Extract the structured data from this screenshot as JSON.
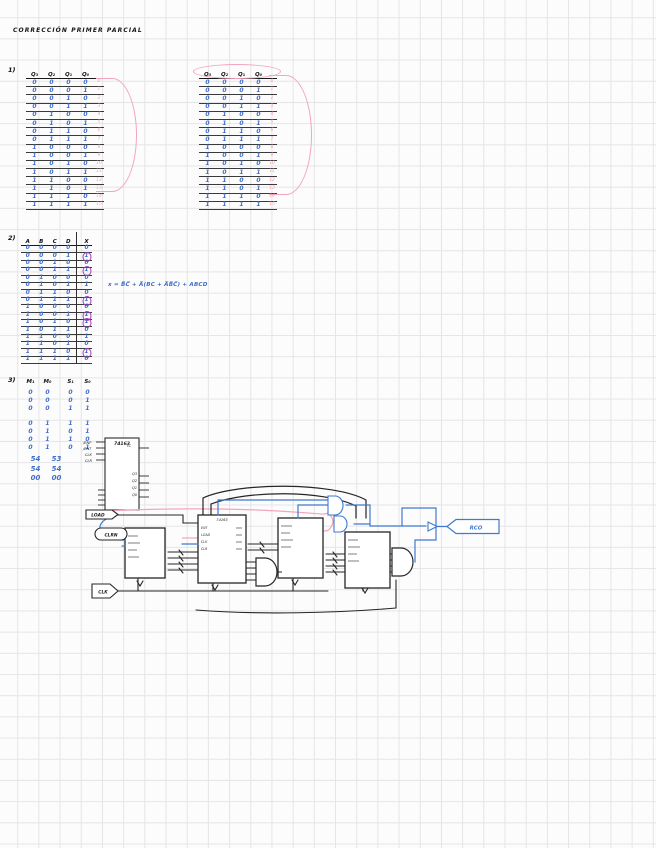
{
  "page": {
    "title": "CORRECCIÓN PRIMER PARCIAL"
  },
  "sections": {
    "s1": {
      "label": "1)",
      "table_a": {
        "headers": [
          "Q₃",
          "Q₂",
          "Q₁",
          "Q₀"
        ],
        "rows": [
          [
            "0",
            "0",
            "0",
            "0",
            "0"
          ],
          [
            "0",
            "0",
            "0",
            "1",
            "1"
          ],
          [
            "0",
            "0",
            "1",
            "0",
            "2"
          ],
          [
            "0",
            "0",
            "1",
            "1",
            "3"
          ],
          [
            "0",
            "1",
            "0",
            "0",
            "4"
          ],
          [
            "0",
            "1",
            "0",
            "1",
            "5"
          ],
          [
            "0",
            "1",
            "1",
            "0",
            "6"
          ],
          [
            "0",
            "1",
            "1",
            "1",
            "7"
          ],
          [
            "1",
            "0",
            "0",
            "0",
            "8"
          ],
          [
            "1",
            "0",
            "0",
            "1",
            "9"
          ],
          [
            "1",
            "0",
            "1",
            "0",
            "10"
          ],
          [
            "1",
            "0",
            "1",
            "1",
            "11"
          ],
          [
            "1",
            "1",
            "0",
            "0",
            "12"
          ],
          [
            "1",
            "1",
            "0",
            "1",
            "13"
          ],
          [
            "1",
            "1",
            "1",
            "0",
            "14"
          ],
          [
            "1",
            "1",
            "1",
            "1",
            "15"
          ]
        ]
      },
      "table_b": {
        "headers": [
          "Q₃",
          "Q₂",
          "Q₁",
          "Q₀"
        ],
        "rows": [
          [
            "0",
            "0",
            "0",
            "0",
            "0"
          ],
          [
            "0",
            "0",
            "0",
            "1",
            "1"
          ],
          [
            "0",
            "0",
            "1",
            "0",
            "2"
          ],
          [
            "0",
            "0",
            "1",
            "1",
            "3"
          ],
          [
            "0",
            "1",
            "0",
            "0",
            "4"
          ],
          [
            "0",
            "1",
            "0",
            "1",
            "5"
          ],
          [
            "0",
            "1",
            "1",
            "0",
            "6"
          ],
          [
            "0",
            "1",
            "1",
            "1",
            "7"
          ],
          [
            "1",
            "0",
            "0",
            "0",
            "8"
          ],
          [
            "1",
            "0",
            "0",
            "1",
            "9"
          ],
          [
            "1",
            "0",
            "1",
            "0",
            "10"
          ],
          [
            "1",
            "0",
            "1",
            "1",
            "11"
          ],
          [
            "1",
            "1",
            "0",
            "0",
            "12"
          ],
          [
            "1",
            "1",
            "0",
            "1",
            "13"
          ],
          [
            "1",
            "1",
            "1",
            "0",
            "14"
          ],
          [
            "1",
            "1",
            "1",
            "1",
            "15"
          ]
        ]
      }
    },
    "s2": {
      "label": "2)",
      "table": {
        "headers": [
          "A",
          "B",
          "C",
          "D",
          "X"
        ],
        "rows": [
          [
            "0",
            "0",
            "0",
            "0",
            "0"
          ],
          [
            "0",
            "0",
            "0",
            "1",
            "*1"
          ],
          [
            "0",
            "0",
            "1",
            "0",
            "0"
          ],
          [
            "0",
            "0",
            "1",
            "1",
            "*1"
          ],
          [
            "0",
            "1",
            "0",
            "0",
            "0"
          ],
          [
            "0",
            "1",
            "0",
            "1",
            "1"
          ],
          [
            "0",
            "1",
            "1",
            "0",
            "0"
          ],
          [
            "0",
            "1",
            "1",
            "1",
            "*1"
          ],
          [
            "1",
            "0",
            "0",
            "0",
            "0"
          ],
          [
            "1",
            "0",
            "0",
            "1",
            "*1"
          ],
          [
            "1",
            "0",
            "1",
            "0",
            "*1"
          ],
          [
            "1",
            "0",
            "1",
            "1",
            "0"
          ],
          [
            "1",
            "1",
            "0",
            "0",
            "1"
          ],
          [
            "1",
            "1",
            "0",
            "1",
            "0"
          ],
          [
            "1",
            "1",
            "1",
            "0",
            "*1"
          ],
          [
            "1",
            "1",
            "1",
            "1",
            "0"
          ]
        ]
      },
      "equation": "x = B̅C̅ + A̅(BC + A̅B̅C̅) + ABCD"
    },
    "s3": {
      "label": "3)",
      "headers": [
        "M₁",
        "M₀",
        "S₁",
        "S₀"
      ],
      "group1": [
        [
          "0",
          "0",
          "0",
          "0"
        ],
        [
          "0",
          "0",
          "0",
          "1"
        ],
        [
          "0",
          "0",
          "1",
          "1"
        ]
      ],
      "group2": [
        [
          "0",
          "1",
          "1",
          "1"
        ],
        [
          "0",
          "1",
          "0",
          "1"
        ],
        [
          "0",
          "1",
          "1",
          "0"
        ],
        [
          "0",
          "1",
          "0",
          "1"
        ]
      ],
      "group3": [
        [
          "54",
          "53"
        ],
        [
          "54",
          "54"
        ],
        [
          "00",
          "00"
        ]
      ]
    }
  },
  "chip": {
    "label": "74163",
    "pins_left": [
      "/ENP",
      "/ENT",
      "CLK",
      "CLR"
    ],
    "pins_right": [
      "TC",
      "Q3",
      "Q2",
      "Q1",
      "Q0"
    ]
  },
  "circuit": {
    "load_tag": "LOAD",
    "clr_tag": "CLRN",
    "clk_tag": "CLK",
    "rco_tag": "RCO",
    "block_label": "74163",
    "block_pins": [
      "ENT",
      "LOAD",
      "CLK",
      "CLR"
    ]
  }
}
